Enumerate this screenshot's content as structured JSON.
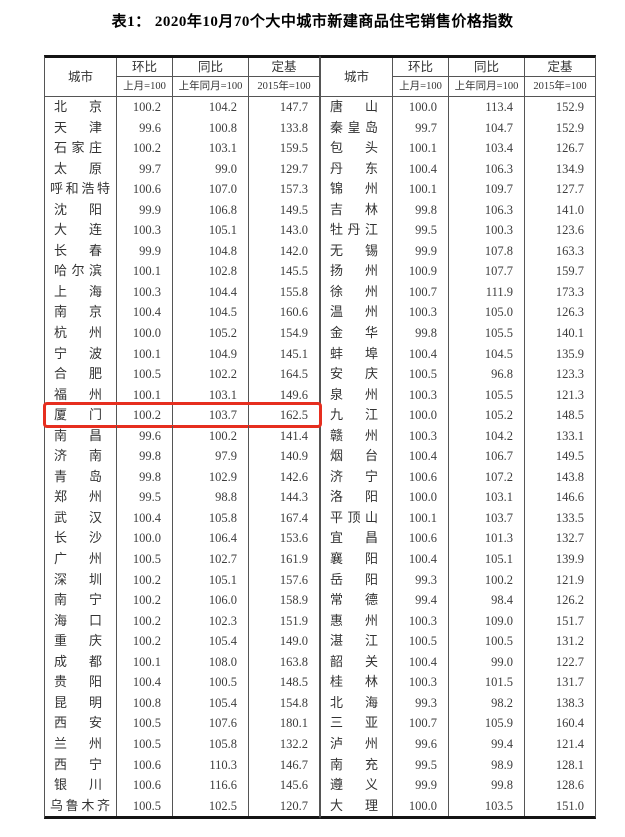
{
  "title": "表1： 2020年10月70个大中城市新建商品住宅销售价格指数",
  "table": {
    "header": {
      "city": "城市",
      "mom": "环比",
      "mom_base": "上月=100",
      "yoy": "同比",
      "yoy_base": "上年同月=100",
      "fixed": "定基",
      "fixed_base": "2015年=100"
    },
    "left_rows": [
      {
        "city": "北京",
        "mom": "100.2",
        "yoy": "104.2",
        "fixed": "147.7"
      },
      {
        "city": "天津",
        "mom": "99.6",
        "yoy": "100.8",
        "fixed": "133.8"
      },
      {
        "city": "石家庄",
        "mom": "100.2",
        "yoy": "103.1",
        "fixed": "159.5"
      },
      {
        "city": "太原",
        "mom": "99.7",
        "yoy": "99.0",
        "fixed": "129.7"
      },
      {
        "city": "呼和浩特",
        "mom": "100.6",
        "yoy": "107.0",
        "fixed": "157.3"
      },
      {
        "city": "沈阳",
        "mom": "99.9",
        "yoy": "106.8",
        "fixed": "149.5"
      },
      {
        "city": "大连",
        "mom": "100.3",
        "yoy": "105.1",
        "fixed": "143.0"
      },
      {
        "city": "长春",
        "mom": "99.9",
        "yoy": "104.8",
        "fixed": "142.0"
      },
      {
        "city": "哈尔滨",
        "mom": "100.1",
        "yoy": "102.8",
        "fixed": "145.5"
      },
      {
        "city": "上海",
        "mom": "100.3",
        "yoy": "104.4",
        "fixed": "155.8"
      },
      {
        "city": "南京",
        "mom": "100.4",
        "yoy": "104.5",
        "fixed": "160.6"
      },
      {
        "city": "杭州",
        "mom": "100.0",
        "yoy": "105.2",
        "fixed": "154.9"
      },
      {
        "city": "宁波",
        "mom": "100.1",
        "yoy": "104.9",
        "fixed": "145.1"
      },
      {
        "city": "合肥",
        "mom": "100.5",
        "yoy": "102.2",
        "fixed": "164.5"
      },
      {
        "city": "福州",
        "mom": "100.1",
        "yoy": "103.1",
        "fixed": "149.6"
      },
      {
        "city": "厦门",
        "mom": "100.2",
        "yoy": "103.7",
        "fixed": "162.5"
      },
      {
        "city": "南昌",
        "mom": "99.6",
        "yoy": "100.2",
        "fixed": "141.4"
      },
      {
        "city": "济南",
        "mom": "99.8",
        "yoy": "97.9",
        "fixed": "140.9"
      },
      {
        "city": "青岛",
        "mom": "99.8",
        "yoy": "102.9",
        "fixed": "142.6"
      },
      {
        "city": "郑州",
        "mom": "99.5",
        "yoy": "98.8",
        "fixed": "144.3"
      },
      {
        "city": "武汉",
        "mom": "100.4",
        "yoy": "105.8",
        "fixed": "167.4"
      },
      {
        "city": "长沙",
        "mom": "100.0",
        "yoy": "106.4",
        "fixed": "153.6"
      },
      {
        "city": "广州",
        "mom": "100.5",
        "yoy": "102.7",
        "fixed": "161.9"
      },
      {
        "city": "深圳",
        "mom": "100.2",
        "yoy": "105.1",
        "fixed": "157.6"
      },
      {
        "city": "南宁",
        "mom": "100.2",
        "yoy": "106.0",
        "fixed": "158.9"
      },
      {
        "city": "海口",
        "mom": "100.2",
        "yoy": "102.3",
        "fixed": "151.9"
      },
      {
        "city": "重庆",
        "mom": "100.2",
        "yoy": "105.4",
        "fixed": "149.0"
      },
      {
        "city": "成都",
        "mom": "100.1",
        "yoy": "108.0",
        "fixed": "163.8"
      },
      {
        "city": "贵阳",
        "mom": "100.4",
        "yoy": "100.5",
        "fixed": "148.5"
      },
      {
        "city": "昆明",
        "mom": "100.8",
        "yoy": "105.4",
        "fixed": "154.8"
      },
      {
        "city": "西安",
        "mom": "100.5",
        "yoy": "107.6",
        "fixed": "180.1"
      },
      {
        "city": "兰州",
        "mom": "100.5",
        "yoy": "105.8",
        "fixed": "132.2"
      },
      {
        "city": "西宁",
        "mom": "100.6",
        "yoy": "110.3",
        "fixed": "146.7"
      },
      {
        "city": "银川",
        "mom": "100.6",
        "yoy": "116.6",
        "fixed": "145.6"
      },
      {
        "city": "乌鲁木齐",
        "mom": "100.5",
        "yoy": "102.5",
        "fixed": "120.7"
      }
    ],
    "right_rows": [
      {
        "city": "唐山",
        "mom": "100.0",
        "yoy": "113.4",
        "fixed": "152.9"
      },
      {
        "city": "秦皇岛",
        "mom": "99.7",
        "yoy": "104.7",
        "fixed": "152.9"
      },
      {
        "city": "包头",
        "mom": "100.1",
        "yoy": "103.4",
        "fixed": "126.7"
      },
      {
        "city": "丹东",
        "mom": "100.4",
        "yoy": "106.3",
        "fixed": "134.9"
      },
      {
        "city": "锦州",
        "mom": "100.1",
        "yoy": "109.7",
        "fixed": "127.7"
      },
      {
        "city": "吉林",
        "mom": "99.8",
        "yoy": "106.3",
        "fixed": "141.0"
      },
      {
        "city": "牡丹江",
        "mom": "99.5",
        "yoy": "100.3",
        "fixed": "123.6"
      },
      {
        "city": "无锡",
        "mom": "99.9",
        "yoy": "107.8",
        "fixed": "163.3"
      },
      {
        "city": "扬州",
        "mom": "100.9",
        "yoy": "107.7",
        "fixed": "159.7"
      },
      {
        "city": "徐州",
        "mom": "100.7",
        "yoy": "111.9",
        "fixed": "173.3"
      },
      {
        "city": "温州",
        "mom": "100.3",
        "yoy": "105.0",
        "fixed": "126.3"
      },
      {
        "city": "金华",
        "mom": "99.8",
        "yoy": "105.5",
        "fixed": "140.1"
      },
      {
        "city": "蚌埠",
        "mom": "100.4",
        "yoy": "104.5",
        "fixed": "135.9"
      },
      {
        "city": "安庆",
        "mom": "100.5",
        "yoy": "96.8",
        "fixed": "123.3"
      },
      {
        "city": "泉州",
        "mom": "100.3",
        "yoy": "105.5",
        "fixed": "121.3"
      },
      {
        "city": "九江",
        "mom": "100.0",
        "yoy": "105.2",
        "fixed": "148.5"
      },
      {
        "city": "赣州",
        "mom": "100.3",
        "yoy": "104.2",
        "fixed": "133.1"
      },
      {
        "city": "烟台",
        "mom": "100.4",
        "yoy": "106.7",
        "fixed": "149.5"
      },
      {
        "city": "济宁",
        "mom": "100.6",
        "yoy": "107.2",
        "fixed": "143.8"
      },
      {
        "city": "洛阳",
        "mom": "100.0",
        "yoy": "103.1",
        "fixed": "146.6"
      },
      {
        "city": "平顶山",
        "mom": "100.1",
        "yoy": "103.7",
        "fixed": "133.5"
      },
      {
        "city": "宜昌",
        "mom": "100.6",
        "yoy": "101.3",
        "fixed": "132.7"
      },
      {
        "city": "襄阳",
        "mom": "100.4",
        "yoy": "105.1",
        "fixed": "139.9"
      },
      {
        "city": "岳阳",
        "mom": "99.3",
        "yoy": "100.2",
        "fixed": "121.9"
      },
      {
        "city": "常德",
        "mom": "99.4",
        "yoy": "98.4",
        "fixed": "126.2"
      },
      {
        "city": "惠州",
        "mom": "100.3",
        "yoy": "109.0",
        "fixed": "151.7"
      },
      {
        "city": "湛江",
        "mom": "100.5",
        "yoy": "100.5",
        "fixed": "131.2"
      },
      {
        "city": "韶关",
        "mom": "100.4",
        "yoy": "99.0",
        "fixed": "122.7"
      },
      {
        "city": "桂林",
        "mom": "100.3",
        "yoy": "101.5",
        "fixed": "131.7"
      },
      {
        "city": "北海",
        "mom": "99.3",
        "yoy": "98.2",
        "fixed": "138.3"
      },
      {
        "city": "三亚",
        "mom": "100.7",
        "yoy": "105.9",
        "fixed": "160.4"
      },
      {
        "city": "泸州",
        "mom": "99.6",
        "yoy": "99.4",
        "fixed": "121.4"
      },
      {
        "city": "南充",
        "mom": "99.5",
        "yoy": "98.9",
        "fixed": "128.1"
      },
      {
        "city": "遵义",
        "mom": "99.9",
        "yoy": "99.8",
        "fixed": "128.6"
      },
      {
        "city": "大理",
        "mom": "100.0",
        "yoy": "103.5",
        "fixed": "151.0"
      }
    ]
  },
  "highlight": {
    "side": "left_rows",
    "row_index": 15,
    "city": "厦门",
    "color": "#e62e1f"
  }
}
